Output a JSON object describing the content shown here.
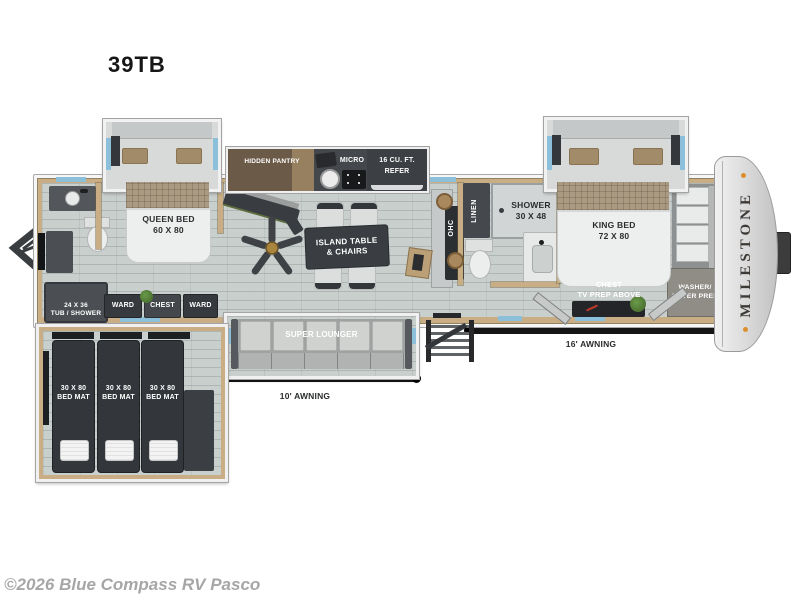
{
  "page": {
    "title": "39TB",
    "copyright": "©2026 Blue Compass RV Pasco"
  },
  "brand": "MILESTONE",
  "rooms": {
    "queen": {
      "line1": "QUEEN BED",
      "line2": "60 X 80"
    },
    "king": {
      "line1": "KING BED",
      "line2": "72 X 80"
    },
    "tub": {
      "line1": "24 X 36",
      "line2": "TUB / SHOWER"
    },
    "shower": {
      "line1": "SHOWER",
      "line2": "30 X 48"
    },
    "linen": "LINEN",
    "ohc": "OHC",
    "ward": "WARD",
    "chest": "CHEST",
    "hidden_pantry": "HIDDEN PANTRY",
    "micro": "MICRO",
    "refer": {
      "line1": "16 CU. FT.",
      "line2": "REFER"
    },
    "island": {
      "line1": "ISLAND TABLE",
      "line2": "& CHAIRS"
    },
    "super_lounger": "SUPER LOUNGER",
    "chest_tv": {
      "line1": "CHEST",
      "line2": "TV PREP ABOVE"
    },
    "washer": {
      "line1": "WASHER/",
      "line2": "DRYER PREP"
    },
    "bed_mat": {
      "line1": "30 X 80",
      "line2": "BED MAT"
    }
  },
  "exterior": {
    "awning_10": "10' AWNING",
    "awning_16": "16' AWNING"
  },
  "colors": {
    "accent_window_blue": "#8cc0da",
    "wall_tan": "#c9ae85",
    "furniture_dark": "#36393d",
    "marker_light_orange": "#dd8e2e"
  }
}
